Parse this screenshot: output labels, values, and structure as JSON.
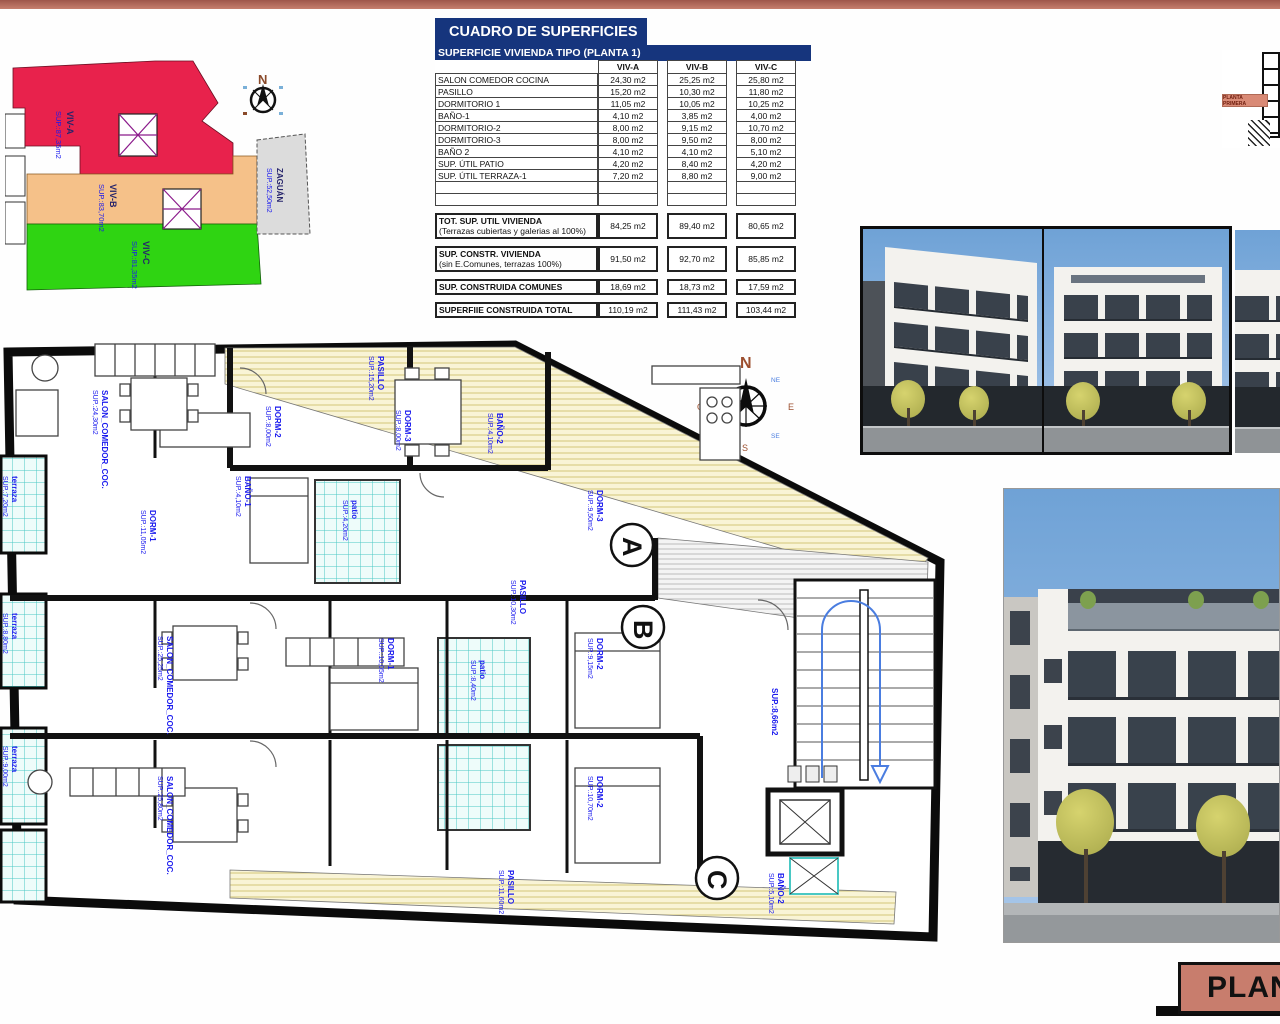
{
  "colors": {
    "accent_salmon": "#bd7164",
    "table_navy": "#16357d",
    "label_blue": "#1a1aee",
    "site_red": "#e8224c",
    "site_orange": "#f5c189",
    "site_green": "#2fd412"
  },
  "table": {
    "title": "CUADRO DE SUPERFICIES",
    "subtitle": "SUPERFICIE VIVIENDA TIPO  (PLANTA 1)",
    "columns": [
      "VIV-A",
      "VIV-B",
      "VIV-C"
    ],
    "rows": [
      {
        "name": "SALON COMEDOR COCINA",
        "a": "24,30 m2",
        "b": "25,25 m2",
        "c": "25,80 m2"
      },
      {
        "name": "PASILLO",
        "a": "15,20 m2",
        "b": "10,30 m2",
        "c": "11,80 m2"
      },
      {
        "name": "DORMITORIO 1",
        "a": "11,05 m2",
        "b": "10,05 m2",
        "c": "10,25 m2"
      },
      {
        "name": "BAÑO-1",
        "a": "4,10 m2",
        "b": "3,85 m2",
        "c": "4,00 m2"
      },
      {
        "name": "DORMITORIO-2",
        "a": "8,00 m2",
        "b": "9,15 m2",
        "c": "10,70 m2"
      },
      {
        "name": "DORMITORIO-3",
        "a": "8,00 m2",
        "b": "9,50 m2",
        "c": "8,00 m2"
      },
      {
        "name": "BAÑO 2",
        "a": "4,10 m2",
        "b": "4,10 m2",
        "c": "5,10 m2"
      },
      {
        "name": "SUP. ÚTIL PATIO",
        "a": "4,20 m2",
        "b": "8,40 m2",
        "c": "4,20 m2"
      },
      {
        "name": "SUP. ÚTIL TERRAZA-1",
        "a": "7,20 m2",
        "b": "8,80 m2",
        "c": "9,00 m2"
      }
    ],
    "summary": [
      {
        "name": "TOT. SUP. UTIL VIVIENDA",
        "note": "(Terrazas cubiertas y galerias al 100%)",
        "a": "84,25 m2",
        "b": "89,40 m2",
        "c": "80,65 m2"
      },
      {
        "name": "SUP. CONSTR. VIVIENDA",
        "note": "(sin E.Comunes, terrazas 100%)",
        "a": "91,50 m2",
        "b": "92,70 m2",
        "c": "85,85 m2"
      },
      {
        "name": "SUP. CONSTRUIDA COMUNES",
        "note": "",
        "a": "18,69 m2",
        "b": "18,73 m2",
        "c": "17,59 m2"
      },
      {
        "name": "SUPERFIIE CONSTRUIDA TOTAL",
        "note": "",
        "a": "110,19 m2",
        "b": "111,43 m2",
        "c": "103,44 m2"
      }
    ]
  },
  "site_plan": {
    "areas": [
      {
        "name": "VIV-A",
        "sup": "SUP.:87,35m2"
      },
      {
        "name": "VIV-B",
        "sup": "SUP.:83,70m2"
      },
      {
        "name": "VIV-C",
        "sup": "SUP.:81,35m2"
      },
      {
        "name": "ZAGUÁN",
        "sup": "SUP.:52,50m2"
      }
    ],
    "compass_n": "N"
  },
  "compass": {
    "n": "N",
    "e": "E",
    "s": "S",
    "w": "O",
    "ne": "NE",
    "nw": "NO",
    "se": "SE",
    "sw": "SO"
  },
  "elevation": {
    "label": "PLANTA PRIMERA"
  },
  "floorplan": {
    "markers": [
      "A",
      "B",
      "C"
    ],
    "labels": [
      {
        "l1": "PASILLO",
        "l2": "SUP.:15,20m2",
        "x": 378,
        "y": 18
      },
      {
        "l1": "SALON_COMEDOR_COC.",
        "l2": "SUP.:24,30m2",
        "x": 102,
        "y": 52
      },
      {
        "l1": "DORM-1",
        "l2": "SUP.:11,05m2",
        "x": 150,
        "y": 172
      },
      {
        "l1": "BAÑO-1",
        "l2": "SUP.:4,10m2",
        "x": 245,
        "y": 138
      },
      {
        "l1": "DORM-2",
        "l2": "SUP.:8,00m2",
        "x": 275,
        "y": 68
      },
      {
        "l1": "DORM-3",
        "l2": "SUP.:8,00m2",
        "x": 405,
        "y": 72
      },
      {
        "l1": "BAÑO-2",
        "l2": "SUP.:4,10m2",
        "x": 497,
        "y": 75
      },
      {
        "l1": "terraza",
        "l2": "SUP.:7,20m2",
        "x": 12,
        "y": 138
      },
      {
        "l1": "terraza",
        "l2": "SUP.:8,80m2",
        "x": 12,
        "y": 275
      },
      {
        "l1": "terraza",
        "l2": "SUP.:9,00m2",
        "x": 12,
        "y": 408
      },
      {
        "l1": "SALON_COMEDOR_COC.",
        "l2": "SUP.:25,25m2",
        "x": 167,
        "y": 298
      },
      {
        "l1": "SALON_COMEDOR_COC.",
        "l2": "SUP.:25,80m2",
        "x": 167,
        "y": 438
      },
      {
        "l1": "DORM-1",
        "l2": "SUP.:10,05m2",
        "x": 388,
        "y": 300
      },
      {
        "l1": "DORM-2",
        "l2": "SUP.:9,15m2",
        "x": 597,
        "y": 300
      },
      {
        "l1": "DORM-3",
        "l2": "SUP.:9,50m2",
        "x": 597,
        "y": 152
      },
      {
        "l1": "DORM-2",
        "l2": "SUP.:10,70m2",
        "x": 597,
        "y": 438
      },
      {
        "l1": "BAÑO-2",
        "l2": "SUP.:5,10m2",
        "x": 778,
        "y": 535
      },
      {
        "l1": "PASILLO",
        "l2": "SUP.:11,60m2",
        "x": 508,
        "y": 532
      },
      {
        "l1": "PASILLO",
        "l2": "SUP.:10,30m2",
        "x": 520,
        "y": 242
      },
      {
        "l1": "SUP.:8,66m2",
        "l2": "",
        "x": 772,
        "y": 350
      },
      {
        "l1": "patio",
        "l2": "SUP.:4,20m2",
        "x": 352,
        "y": 162
      },
      {
        "l1": "patio",
        "l2": "SUP.:8,40m2",
        "x": 480,
        "y": 322
      }
    ]
  },
  "footer": {
    "label": "PLANTA"
  }
}
